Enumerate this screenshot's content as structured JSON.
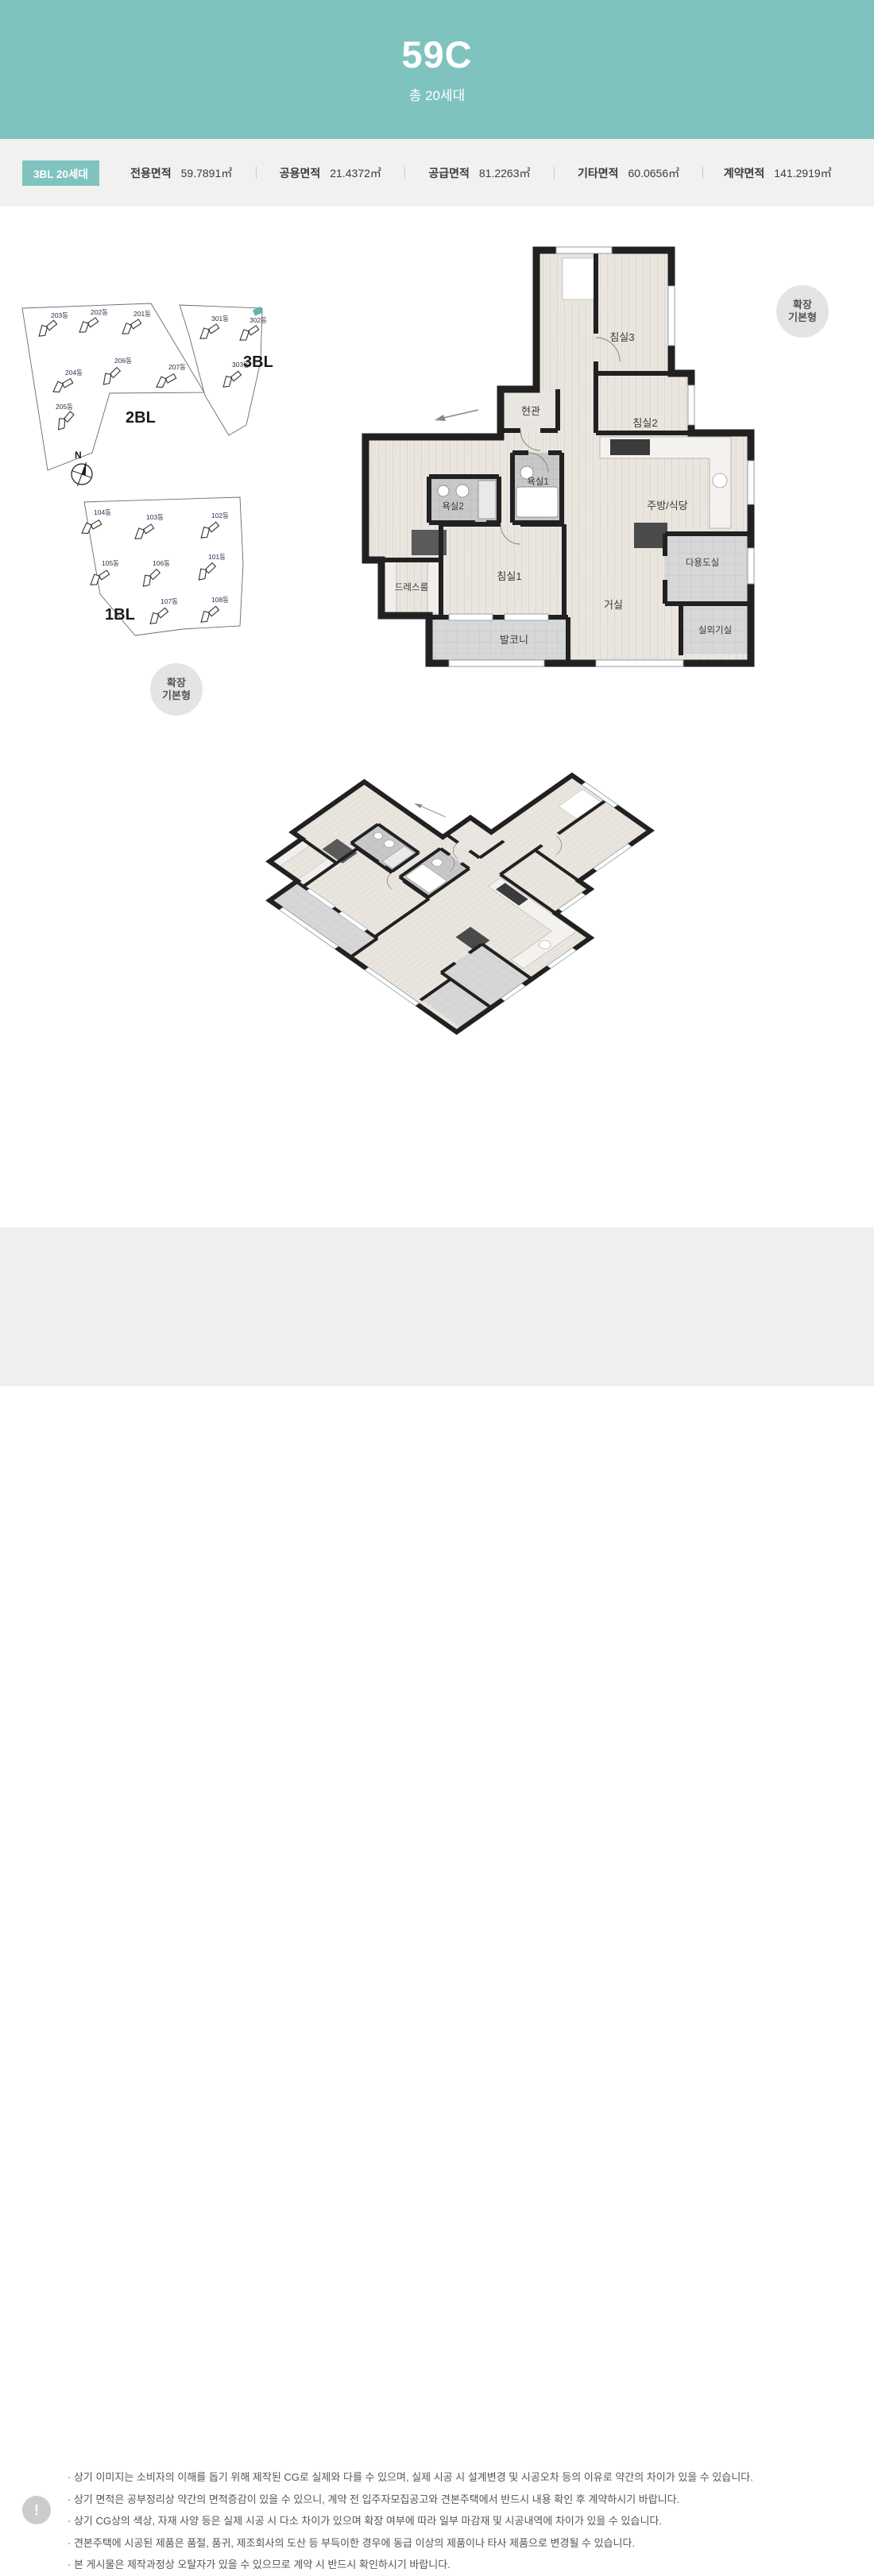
{
  "header": {
    "title": "59C",
    "subtitle": "총 20세대",
    "accent_color": "#7fc3bf"
  },
  "specs": {
    "block_label": "3BL 20세대",
    "items": [
      {
        "label": "전용면적",
        "value": "59.7891㎡"
      },
      {
        "label": "공용면적",
        "value": "21.4372㎡"
      },
      {
        "label": "공급면적",
        "value": "81.2263㎡"
      },
      {
        "label": "기타면적",
        "value": "60.0656㎡"
      },
      {
        "label": "계약면적",
        "value": "141.2919㎡"
      }
    ]
  },
  "siteplan": {
    "compass": "N",
    "highlight_color": "#5fb3ae",
    "blocks": [
      {
        "name": "2BL",
        "buildings": [
          "203동",
          "202동",
          "201동",
          "204동",
          "206동",
          "207동",
          "205동"
        ]
      },
      {
        "name": "3BL",
        "buildings": [
          "301동",
          "302동",
          "303동"
        ]
      },
      {
        "name": "1BL",
        "buildings": [
          "104동",
          "103동",
          "102동",
          "105동",
          "106동",
          "101동",
          "107동",
          "108동"
        ]
      }
    ]
  },
  "floorplan": {
    "badge": {
      "line1": "확장",
      "line2": "기본형"
    },
    "rooms": [
      "침실3",
      "침실2",
      "현관",
      "욕실1",
      "욕실2",
      "주방/식당",
      "다용도실",
      "드레스룸",
      "침실1",
      "거실",
      "발코니",
      "실외기실"
    ]
  },
  "iso": {
    "badge": {
      "line1": "확장",
      "line2": "기본형"
    }
  },
  "disclaimer": {
    "icon": "!",
    "items": [
      "· 상기 이미지는 소비자의 이해를 돕기 위해 제작된 CG로 실제와 다를 수 있으며, 실제 시공 시 설계변경 및 시공오차 등의 이유로 약간의 차이가 있을 수 있습니다.",
      "· 상기 면적은 공부정리상 약간의 면적증감이 있을 수 있으니, 계약 전 입주자모집공고와 견본주택에서 반드시 내용 확인 후 계약하시기 바랍니다.",
      "· 상기 CG상의 색상, 자재 사양 등은 실제 시공 시 다소 차이가 있으며 확장 여부에 따라 일부 마감재 및 시공내역에 차이가 있을 수 있습니다.",
      "· 견본주택에 시공된 제품은 품절, 품귀, 제조회사의 도산 등 부득이한 경우에 동급 이상의 제품이나 타사 제품으로 변경될 수 있습니다.",
      "· 본 게시물은 제작과정상 오탈자가 있을 수 있으므로 계약 시 반드시 확인하시기 바랍니다."
    ]
  }
}
